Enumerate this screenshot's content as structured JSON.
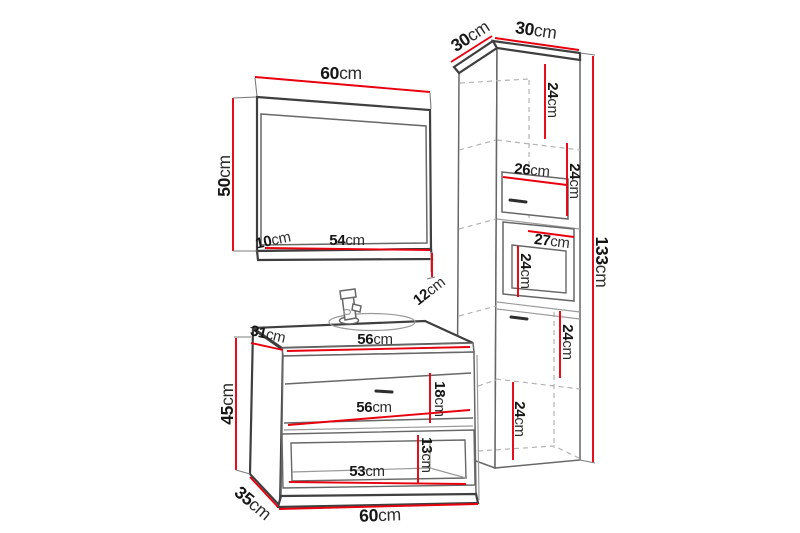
{
  "colors": {
    "bg": "#ffffff",
    "red": "#e8000f",
    "line_dark": "#3f3f3f",
    "line_mid": "#676767",
    "line_light": "#9a9a9a",
    "dash": "#b3b3b3",
    "text": "#161616"
  },
  "mirror": {
    "width": {
      "value": "60",
      "unit": "cm"
    },
    "height": {
      "value": "50",
      "unit": "cm"
    },
    "shelf_offset": {
      "value": "10",
      "unit": "cm"
    },
    "shelf_width": {
      "value": "54",
      "unit": "cm"
    },
    "shelf_depth": {
      "value": "12",
      "unit": "cm"
    }
  },
  "vanity": {
    "top_depth": {
      "value": "31",
      "unit": "cm"
    },
    "top_width": {
      "value": "56",
      "unit": "cm"
    },
    "height": {
      "value": "45",
      "unit": "cm"
    },
    "drawer_height": {
      "value": "18",
      "unit": "cm"
    },
    "drawer_width": {
      "value": "56",
      "unit": "cm"
    },
    "niche_height": {
      "value": "13",
      "unit": "cm"
    },
    "niche_width": {
      "value": "53",
      "unit": "cm"
    },
    "depth": {
      "value": "35",
      "unit": "cm"
    },
    "width": {
      "value": "60",
      "unit": "cm"
    }
  },
  "tall_cabinet": {
    "depth": {
      "value": "30",
      "unit": "cm"
    },
    "width": {
      "value": "30",
      "unit": "cm"
    },
    "top_section_height": {
      "value": "24",
      "unit": "cm"
    },
    "drawer_width": {
      "value": "26",
      "unit": "cm"
    },
    "drawer_height": {
      "value": "24",
      "unit": "cm"
    },
    "door_width": {
      "value": "27",
      "unit": "cm"
    },
    "door_height": {
      "value": "24",
      "unit": "cm"
    },
    "middle_section_height": {
      "value": "24",
      "unit": "cm"
    },
    "bottom_section_height": {
      "value": "24",
      "unit": "cm"
    },
    "height": {
      "value": "133",
      "unit": "cm"
    }
  }
}
